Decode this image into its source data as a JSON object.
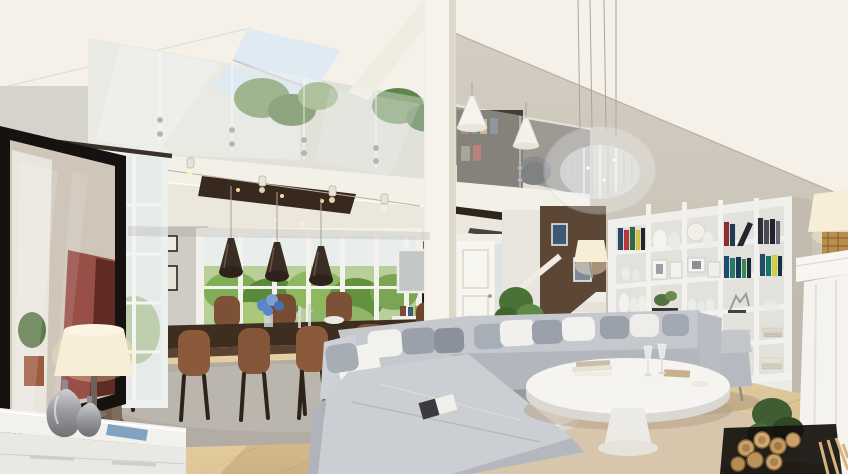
{
  "scene": {
    "description": "Photorealistic 3D rendering of a double-height open-plan living room with a glass-railed mezzanine, skylight, gray sectional sofa, dining area with brown leather chairs, built-in white bookshelf wall, staircase with dark accent wall and white fireplace mantel.",
    "objects": [
      "vaulted-ceiling",
      "skylight",
      "mezzanine-glass-balustrade",
      "mezzanine-plants",
      "mezzanine-bookshelf",
      "office-chair",
      "white-pendant-lights",
      "crystal-chandelier",
      "structural-column",
      "ceiling-soffit",
      "track-spotlights",
      "recessed-ceiling-panel",
      "dining-window-wall",
      "framed-pictures",
      "front-door",
      "wall-mirror",
      "console-table",
      "staircase",
      "stair-accent-wall",
      "wall-sconce",
      "bookshelf-unit",
      "fireplace-mantel",
      "mantel-lamp",
      "wood-floor",
      "dining-rug",
      "living-rug",
      "dining-table",
      "dining-chairs",
      "pendant-lamps",
      "flower-vase",
      "sectional-sofa",
      "sofa-pillows",
      "magazine",
      "daybed",
      "coffee-table",
      "side-table",
      "wine-glasses",
      "framed-artwork",
      "window",
      "curtain",
      "table-lamp",
      "decor-vases",
      "sideboard",
      "log-basket",
      "floor-plant",
      "stair-plants"
    ]
  },
  "palette": {
    "ceiling": "#f5f1e9",
    "wall_right": "#c9c2b6",
    "wall_left": "#d6d3cd",
    "wall_back": "#cfccc5",
    "fascia": "#f3f0e8",
    "column": "#f6f3ec",
    "soffit": "#ece7dd",
    "panel_dark": "#38291f",
    "stair_wall": "#5c4737",
    "door": "#f7f5f0",
    "rug_dining": "#b2aca4",
    "rug_living": "#d7c5ac",
    "sofa": "#c5c8cd",
    "chaise": "#cbced3",
    "pillow_white": "#f2f1ee",
    "pillow_gray": "#9aa1ab",
    "chair_brown": "#8a5a3b",
    "table_wood": "#3e2e1f",
    "pendant_dark": "#3a2d24",
    "bookshelf": "#f0efec",
    "shelf_back": "#e2e1dc",
    "fireplace": "#f4f3ef",
    "curtain": "#6f5d50",
    "frame_black": "#16120f",
    "lamp_shade": "#f7eed8",
    "skylight_blue": "#dfeaf2",
    "plant_green": "#4e7a3a",
    "flowers_blue": "#5d84c6",
    "logs": "#c9a26a"
  }
}
